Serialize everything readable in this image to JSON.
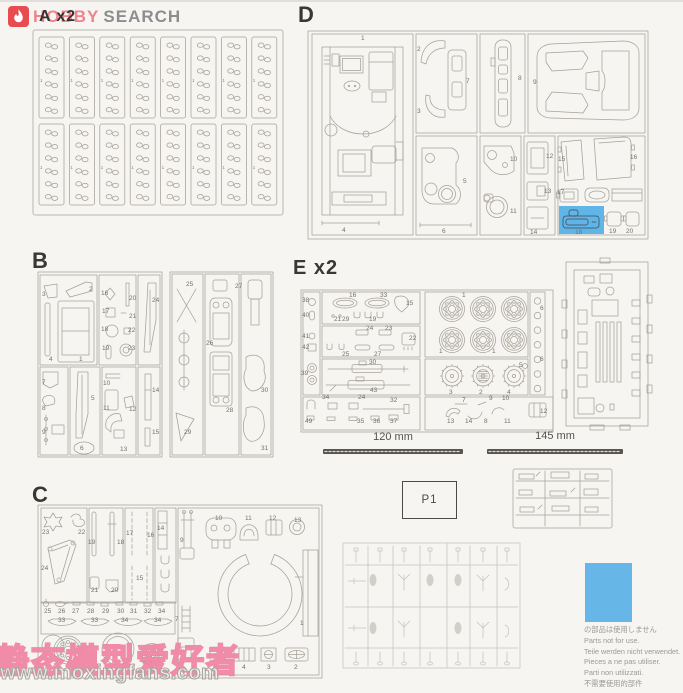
{
  "logo": {
    "word1": "HOBBY",
    "word2": "SEARCH",
    "icon_bg": "#e84b50",
    "word1_color": "#f0838b",
    "word2_color": "#8d8d8d"
  },
  "sprue_labels": {
    "a": "A x2",
    "b": "B",
    "c": "C",
    "d": "D",
    "e": "E x2"
  },
  "sprue_a": {
    "part_number": "1",
    "rows": 2,
    "cols": 8,
    "links_per_strip": 6
  },
  "measurements": {
    "rod1_label": "120 mm",
    "rod2_label": "145 mm"
  },
  "bag_label": "P1",
  "not_for_use": {
    "swatch_color": "#66b7e8",
    "highlight_color": "#5fb4e8",
    "lines": [
      "の部品は使用しません",
      "Parts not for use.",
      "Teile werden nicht verwendet.",
      "Pieces a ne pas utiliser.",
      "Parti non utilizzati.",
      "不需要使用的部件"
    ]
  },
  "watermark": {
    "site_name_cn": "静态模型爱好者",
    "site_url": "www.moxingfans.com"
  },
  "part_labels": {
    "d": [
      {
        "t": "1",
        "x": 361,
        "y": 36
      },
      {
        "t": "4",
        "x": 342,
        "y": 228
      },
      {
        "t": "2",
        "x": 417,
        "y": 47
      },
      {
        "t": "3",
        "x": 417,
        "y": 109
      },
      {
        "t": "7",
        "x": 466,
        "y": 79
      },
      {
        "t": "5",
        "x": 463,
        "y": 179
      },
      {
        "t": "6",
        "x": 442,
        "y": 229
      },
      {
        "t": "8",
        "x": 518,
        "y": 76
      },
      {
        "t": "9",
        "x": 533,
        "y": 80
      },
      {
        "t": "10",
        "x": 510,
        "y": 157
      },
      {
        "t": "11",
        "x": 510,
        "y": 209
      },
      {
        "t": "12",
        "x": 546,
        "y": 154
      },
      {
        "t": "13",
        "x": 544,
        "y": 189
      },
      {
        "t": "14",
        "x": 530,
        "y": 230
      },
      {
        "t": "15",
        "x": 558,
        "y": 157
      },
      {
        "t": "16",
        "x": 630,
        "y": 155
      },
      {
        "t": "17",
        "x": 557,
        "y": 190
      },
      {
        "t": "18",
        "x": 575,
        "y": 230
      },
      {
        "t": "19",
        "x": 609,
        "y": 229
      },
      {
        "t": "20",
        "x": 626,
        "y": 229
      }
    ],
    "b": [
      {
        "t": "3",
        "x": 42,
        "y": 292
      },
      {
        "t": "2",
        "x": 89,
        "y": 287
      },
      {
        "t": "4",
        "x": 49,
        "y": 357
      },
      {
        "t": "1",
        "x": 79,
        "y": 357
      },
      {
        "t": "16",
        "x": 101,
        "y": 291
      },
      {
        "t": "17",
        "x": 102,
        "y": 309
      },
      {
        "t": "18",
        "x": 101,
        "y": 327
      },
      {
        "t": "19",
        "x": 102,
        "y": 346
      },
      {
        "t": "20",
        "x": 129,
        "y": 296
      },
      {
        "t": "21",
        "x": 129,
        "y": 314
      },
      {
        "t": "22",
        "x": 128,
        "y": 328
      },
      {
        "t": "23",
        "x": 128,
        "y": 346
      },
      {
        "t": "24",
        "x": 152,
        "y": 298
      },
      {
        "t": "7",
        "x": 42,
        "y": 380
      },
      {
        "t": "8",
        "x": 42,
        "y": 406
      },
      {
        "t": "9",
        "x": 42,
        "y": 430
      },
      {
        "t": "5",
        "x": 91,
        "y": 396
      },
      {
        "t": "6",
        "x": 80,
        "y": 446
      },
      {
        "t": "10",
        "x": 103,
        "y": 381
      },
      {
        "t": "11",
        "x": 103,
        "y": 406
      },
      {
        "t": "12",
        "x": 129,
        "y": 407
      },
      {
        "t": "13",
        "x": 120,
        "y": 447
      },
      {
        "t": "14",
        "x": 152,
        "y": 388
      },
      {
        "t": "15",
        "x": 152,
        "y": 430
      },
      {
        "t": "25",
        "x": 186,
        "y": 282
      },
      {
        "t": "27",
        "x": 235,
        "y": 284
      },
      {
        "t": "26",
        "x": 206,
        "y": 341
      },
      {
        "t": "28",
        "x": 226,
        "y": 408
      },
      {
        "t": "29",
        "x": 184,
        "y": 430
      },
      {
        "t": "30",
        "x": 261,
        "y": 388
      },
      {
        "t": "31",
        "x": 261,
        "y": 446
      }
    ],
    "c": [
      {
        "t": "23",
        "x": 42,
        "y": 530
      },
      {
        "t": "22",
        "x": 78,
        "y": 530
      },
      {
        "t": "24",
        "x": 41,
        "y": 566
      },
      {
        "t": "19",
        "x": 88,
        "y": 540
      },
      {
        "t": "18",
        "x": 117,
        "y": 540
      },
      {
        "t": "21",
        "x": 91,
        "y": 588
      },
      {
        "t": "20",
        "x": 111,
        "y": 588
      },
      {
        "t": "17",
        "x": 126,
        "y": 531
      },
      {
        "t": "16",
        "x": 147,
        "y": 533
      },
      {
        "t": "15",
        "x": 136,
        "y": 576
      },
      {
        "t": "14",
        "x": 157,
        "y": 526
      },
      {
        "t": "9",
        "x": 180,
        "y": 538
      },
      {
        "t": "10",
        "x": 215,
        "y": 516
      },
      {
        "t": "11",
        "x": 245,
        "y": 516
      },
      {
        "t": "12",
        "x": 269,
        "y": 516
      },
      {
        "t": "13",
        "x": 294,
        "y": 518
      },
      {
        "t": "1",
        "x": 300,
        "y": 621
      },
      {
        "t": "7",
        "x": 175,
        "y": 617
      },
      {
        "t": "8",
        "x": 175,
        "y": 649
      },
      {
        "t": "5",
        "x": 215,
        "y": 665
      },
      {
        "t": "4",
        "x": 242,
        "y": 665
      },
      {
        "t": "3",
        "x": 267,
        "y": 665
      },
      {
        "t": "2",
        "x": 294,
        "y": 665
      },
      {
        "t": "25",
        "x": 44,
        "y": 609
      },
      {
        "t": "26",
        "x": 58,
        "y": 609
      },
      {
        "t": "27",
        "x": 72,
        "y": 609
      },
      {
        "t": "28",
        "x": 87,
        "y": 609
      },
      {
        "t": "29",
        "x": 102,
        "y": 609
      },
      {
        "t": "30",
        "x": 117,
        "y": 609
      },
      {
        "t": "31",
        "x": 130,
        "y": 609
      },
      {
        "t": "32",
        "x": 144,
        "y": 609
      },
      {
        "t": "34",
        "x": 158,
        "y": 609
      },
      {
        "t": "33",
        "x": 58,
        "y": 618
      },
      {
        "t": "33",
        "x": 91,
        "y": 618
      },
      {
        "t": "34",
        "x": 121,
        "y": 618
      },
      {
        "t": "34",
        "x": 154,
        "y": 618
      }
    ],
    "e": [
      {
        "t": "38",
        "x": 302,
        "y": 298
      },
      {
        "t": "40",
        "x": 302,
        "y": 313
      },
      {
        "t": "41",
        "x": 302,
        "y": 334
      },
      {
        "t": "42",
        "x": 302,
        "y": 345
      },
      {
        "t": "39",
        "x": 301,
        "y": 371
      },
      {
        "t": "16",
        "x": 349,
        "y": 293
      },
      {
        "t": "33",
        "x": 380,
        "y": 293
      },
      {
        "t": "15",
        "x": 406,
        "y": 301
      },
      {
        "t": "21",
        "x": 334,
        "y": 317
      },
      {
        "t": "29",
        "x": 342,
        "y": 317
      },
      {
        "t": "19",
        "x": 369,
        "y": 317
      },
      {
        "t": "24",
        "x": 366,
        "y": 326
      },
      {
        "t": "23",
        "x": 385,
        "y": 326
      },
      {
        "t": "22",
        "x": 409,
        "y": 336
      },
      {
        "t": "25",
        "x": 342,
        "y": 352
      },
      {
        "t": "27",
        "x": 374,
        "y": 352
      },
      {
        "t": "30",
        "x": 369,
        "y": 360
      },
      {
        "t": "43",
        "x": 370,
        "y": 388
      },
      {
        "t": "34",
        "x": 322,
        "y": 395
      },
      {
        "t": "24",
        "x": 358,
        "y": 395
      },
      {
        "t": "32",
        "x": 390,
        "y": 398
      },
      {
        "t": "49",
        "x": 305,
        "y": 419
      },
      {
        "t": "35",
        "x": 357,
        "y": 419
      },
      {
        "t": "36",
        "x": 373,
        "y": 419
      },
      {
        "t": "37",
        "x": 390,
        "y": 419
      },
      {
        "t": "1",
        "x": 462,
        "y": 293
      },
      {
        "t": "1",
        "x": 439,
        "y": 349
      },
      {
        "t": "1",
        "x": 492,
        "y": 349
      },
      {
        "t": "3",
        "x": 449,
        "y": 390
      },
      {
        "t": "2",
        "x": 479,
        "y": 390
      },
      {
        "t": "4",
        "x": 507,
        "y": 390
      },
      {
        "t": "5",
        "x": 519,
        "y": 363
      },
      {
        "t": "6",
        "x": 540,
        "y": 306
      },
      {
        "t": "6",
        "x": 540,
        "y": 357
      },
      {
        "t": "7",
        "x": 462,
        "y": 398
      },
      {
        "t": "9",
        "x": 489,
        "y": 396
      },
      {
        "t": "10",
        "x": 502,
        "y": 396
      },
      {
        "t": "13",
        "x": 447,
        "y": 419
      },
      {
        "t": "14",
        "x": 465,
        "y": 419
      },
      {
        "t": "8",
        "x": 484,
        "y": 419
      },
      {
        "t": "11",
        "x": 504,
        "y": 419
      },
      {
        "t": "12",
        "x": 540,
        "y": 409
      }
    ]
  }
}
